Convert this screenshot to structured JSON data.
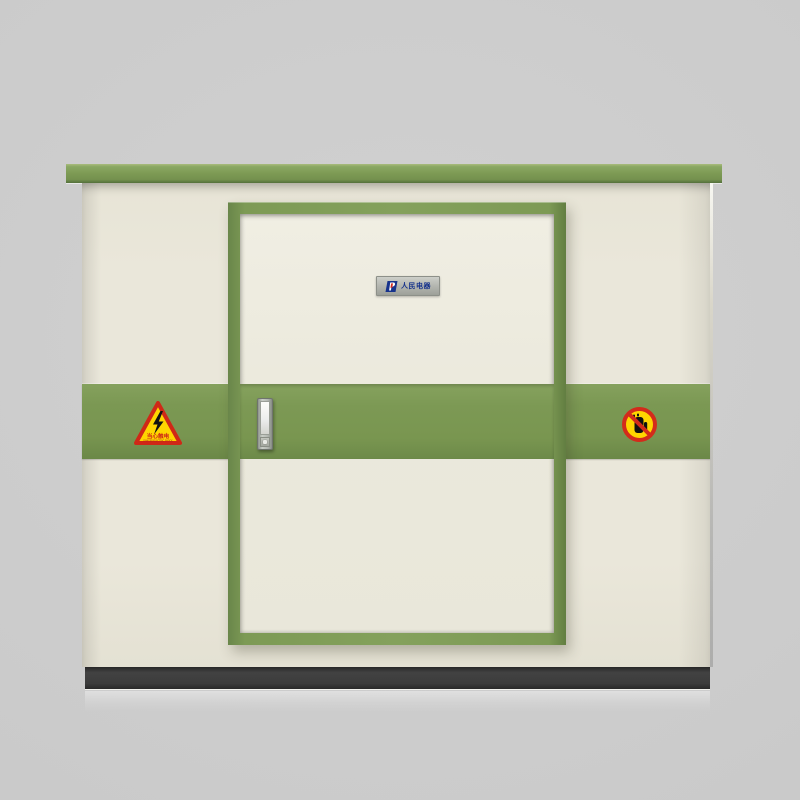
{
  "scene": {
    "type": "product-photo",
    "subject": "box-type electrical substation cabinet with green trim"
  },
  "brand_plate": {
    "logo_icon": "people-electric-logo",
    "text": "人民电器"
  },
  "warning_electric": {
    "icon": "lightning-bolt-icon",
    "title": "当心触电",
    "subtitle": "DANGER!ELECTRIC SHOCK"
  },
  "warning_no_touch": {
    "icon": "no-touch-hand-icon"
  },
  "colors": {
    "cabinet_green": "#7b9853",
    "cabinet_cream": "#eae7da",
    "door_panel_cream": "#ebe9dc",
    "base_dark": "#3a3a3a",
    "warning_yellow": "#ffd500",
    "warning_red": "#d32b1b",
    "logo_blue": "#17338c",
    "background_gray": "#cbcbcb"
  }
}
